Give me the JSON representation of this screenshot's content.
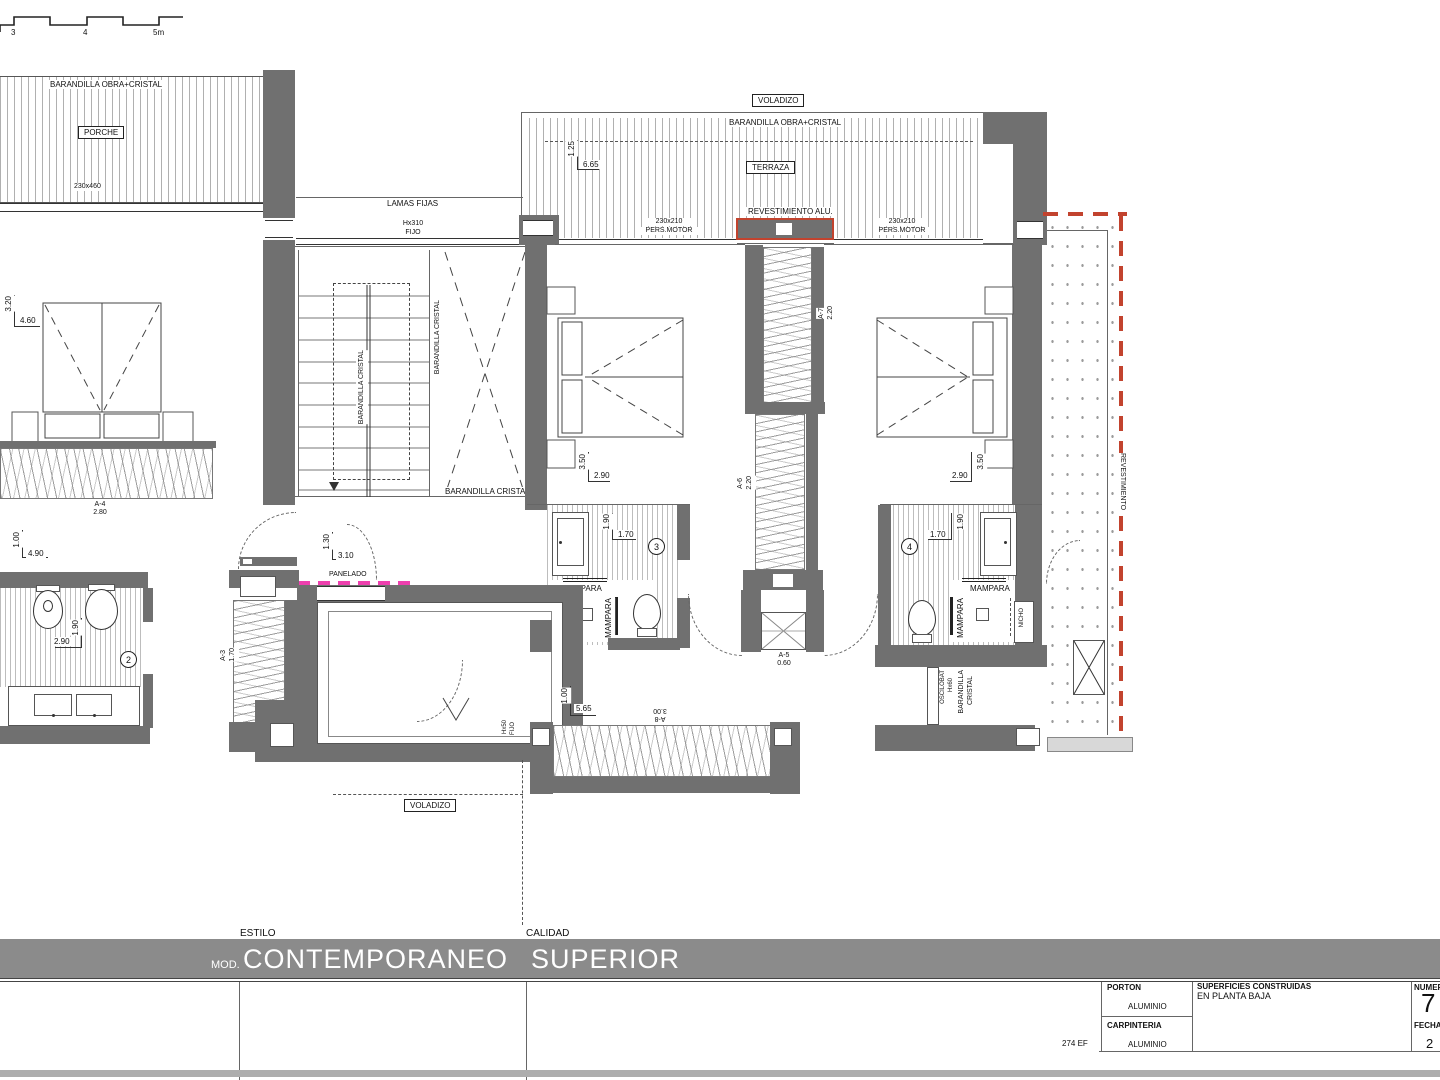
{
  "colors": {
    "wall": "#707070",
    "title_bar": "#8b8b8b",
    "red_dash": "#c2432e",
    "magenta_dash": "#ee3fae"
  },
  "scalebar": {
    "m3": "3",
    "m4": "4",
    "m5": "5m"
  },
  "porch": {
    "rail": "BARANDILLA OBRA+CRISTAL",
    "name": "PORCHE",
    "size": "230x460"
  },
  "lamas": {
    "name": "LAMAS FIJAS",
    "h": "Hx310",
    "type": "FIJO"
  },
  "terraza": {
    "voladizo": "VOLADIZO",
    "rail": "BARANDILLA OBRA+CRISTAL",
    "name": "TERRAZA",
    "dim_v": "1.25",
    "dim_h": "6.65",
    "revest": "REVESTIMIENTO ALU.",
    "pers_left_size": "230x210",
    "pers_left_type": "PERS.MOTOR",
    "pers_right_size": "230x210",
    "pers_right_type": "PERS.MOTOR"
  },
  "bed1": {
    "dim_v": "3.20",
    "dim_h": "4.60",
    "win_code": "A-4",
    "win_size": "2.80"
  },
  "stairs": {
    "rail_a": "BARANDILLA CRISTAL",
    "rail_b": "BARANDILLA CRISTAL",
    "rail_c": "BARANDILLA CRISTAL"
  },
  "bed3": {
    "dim_v": "3.50",
    "dim_h": "2.90"
  },
  "bath3": {
    "dim_v": "1.90",
    "dim_h": "1.70",
    "num": "3",
    "mampara_h": "MAMPARA",
    "mampara_v": "MAMPARA",
    "nicho": "NICHO"
  },
  "corridor": {
    "a7": "A-7",
    "a7_size": "2.20",
    "a6": "A-6",
    "a6_size": "2.20",
    "a5": "A-5",
    "a5_size": "0.60"
  },
  "bed4": {
    "dim_v": "3.50",
    "dim_h": "2.90"
  },
  "bath4": {
    "dim_v": "1.90",
    "dim_h": "1.70",
    "num": "4",
    "mampara_h": "MAMPARA",
    "mampara_v": "MAMPARA",
    "nicho": "NICHO"
  },
  "east": {
    "win_h": "Hx60",
    "win_type": "OSCILOBAT",
    "rail_1": "BARANDILLA",
    "rail_2": "CRISTAL",
    "revest": "REVESTIMIENTO"
  },
  "hall": {
    "dim_v": "1.30",
    "dim_h": "3.10",
    "panelado": "PANELADO",
    "a3": "A-3",
    "a3_size": "1.70",
    "win_h": "Hx50",
    "win_type": "FIJO",
    "voladizo": "VOLADIZO"
  },
  "bath2": {
    "dim_top_v": "1.00",
    "dim_top_h": "4.90",
    "dim_v": "1.90",
    "dim_h": "2.90",
    "num": "2"
  },
  "win8": {
    "dim_v": "1.00",
    "dim_h": "5.65",
    "code": "A-8",
    "size": "3.00"
  },
  "titleblock": {
    "estilo_label": "ESTILO",
    "mod": "MOD.",
    "estilo": "CONTEMPORANEO",
    "calidad_label": "CALIDAD",
    "calidad": "SUPERIOR"
  },
  "infotable": {
    "porton_label": "PORTON",
    "porton": "ALUMINIO",
    "carpinteria_label": "CARPINTERIA",
    "carpinteria": "ALUMINIO",
    "superficies_label": "SUPERFICIES CONSTRUIDAS",
    "superficies": "EN PLANTA BAJA",
    "numero_label": "NUMER",
    "numero": "7",
    "fecha_label": "FECHA",
    "fecha": "2",
    "ref": "274 EF"
  }
}
